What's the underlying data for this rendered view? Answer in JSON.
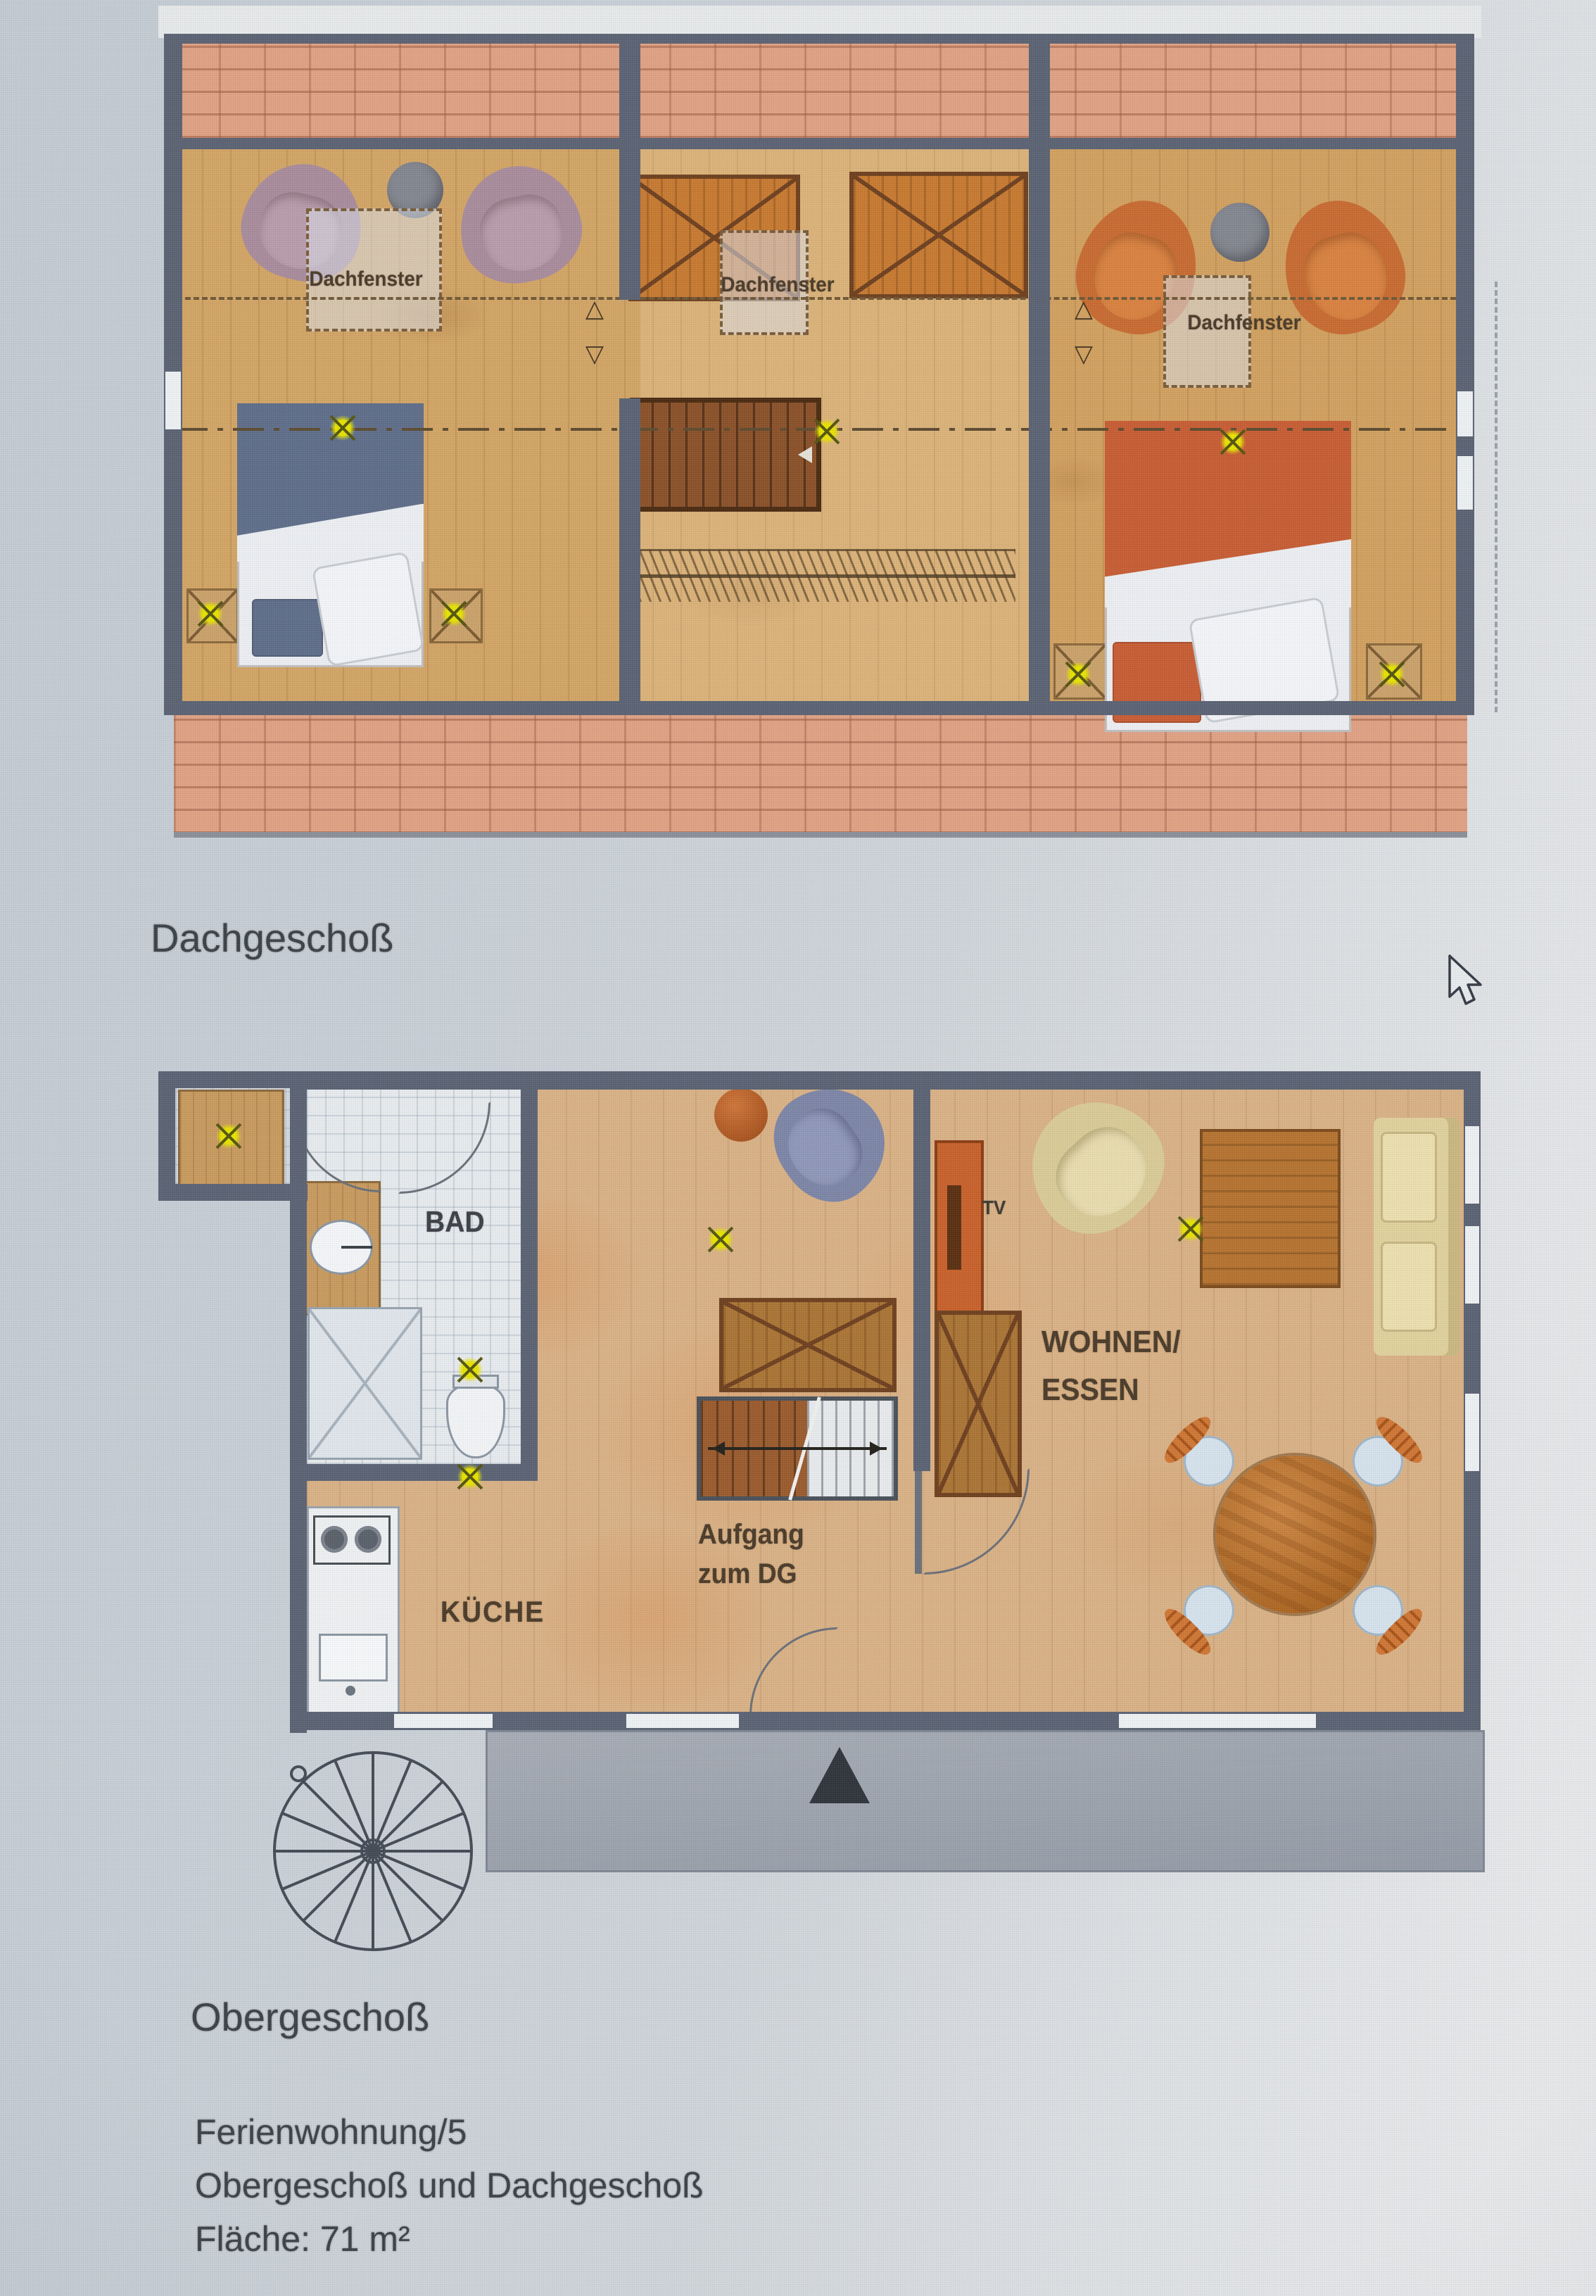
{
  "screen": {
    "cursor_icon": "arrow-pointer"
  },
  "attic_plan": {
    "title": "Dachgeschoß",
    "skylight_labels": [
      "Dachfenster",
      "Dachfenster",
      "Dachfenster"
    ]
  },
  "upper_plan": {
    "title": "Obergeschoß",
    "rooms": {
      "bathroom": "BAD",
      "kitchen": "KÜCHE",
      "living_dining_line1": "WOHNEN/",
      "living_dining_line2": "ESSEN",
      "tv": "TV"
    },
    "stairs_note_line1": "Aufgang",
    "stairs_note_line2": "zum DG"
  },
  "caption": {
    "apartment": "Ferienwohnung/5",
    "floors": "Obergeschoß und Dachgeschoß",
    "area": "Fläche: 71 m²"
  },
  "colors": {
    "background": "#c9d0d7",
    "wall": "#5a6273",
    "attic_floor": "#d2a464",
    "upper_floor": "#d9b185",
    "brick": "#e0a183",
    "lamp_symbol": "#e3df00",
    "bed_blue": "#5e6d89",
    "bed_orange": "#c75c33",
    "armchair_mauve": "#a88b9b",
    "armchair_orange": "#c86a30",
    "terrace": "#9aa1ab"
  }
}
